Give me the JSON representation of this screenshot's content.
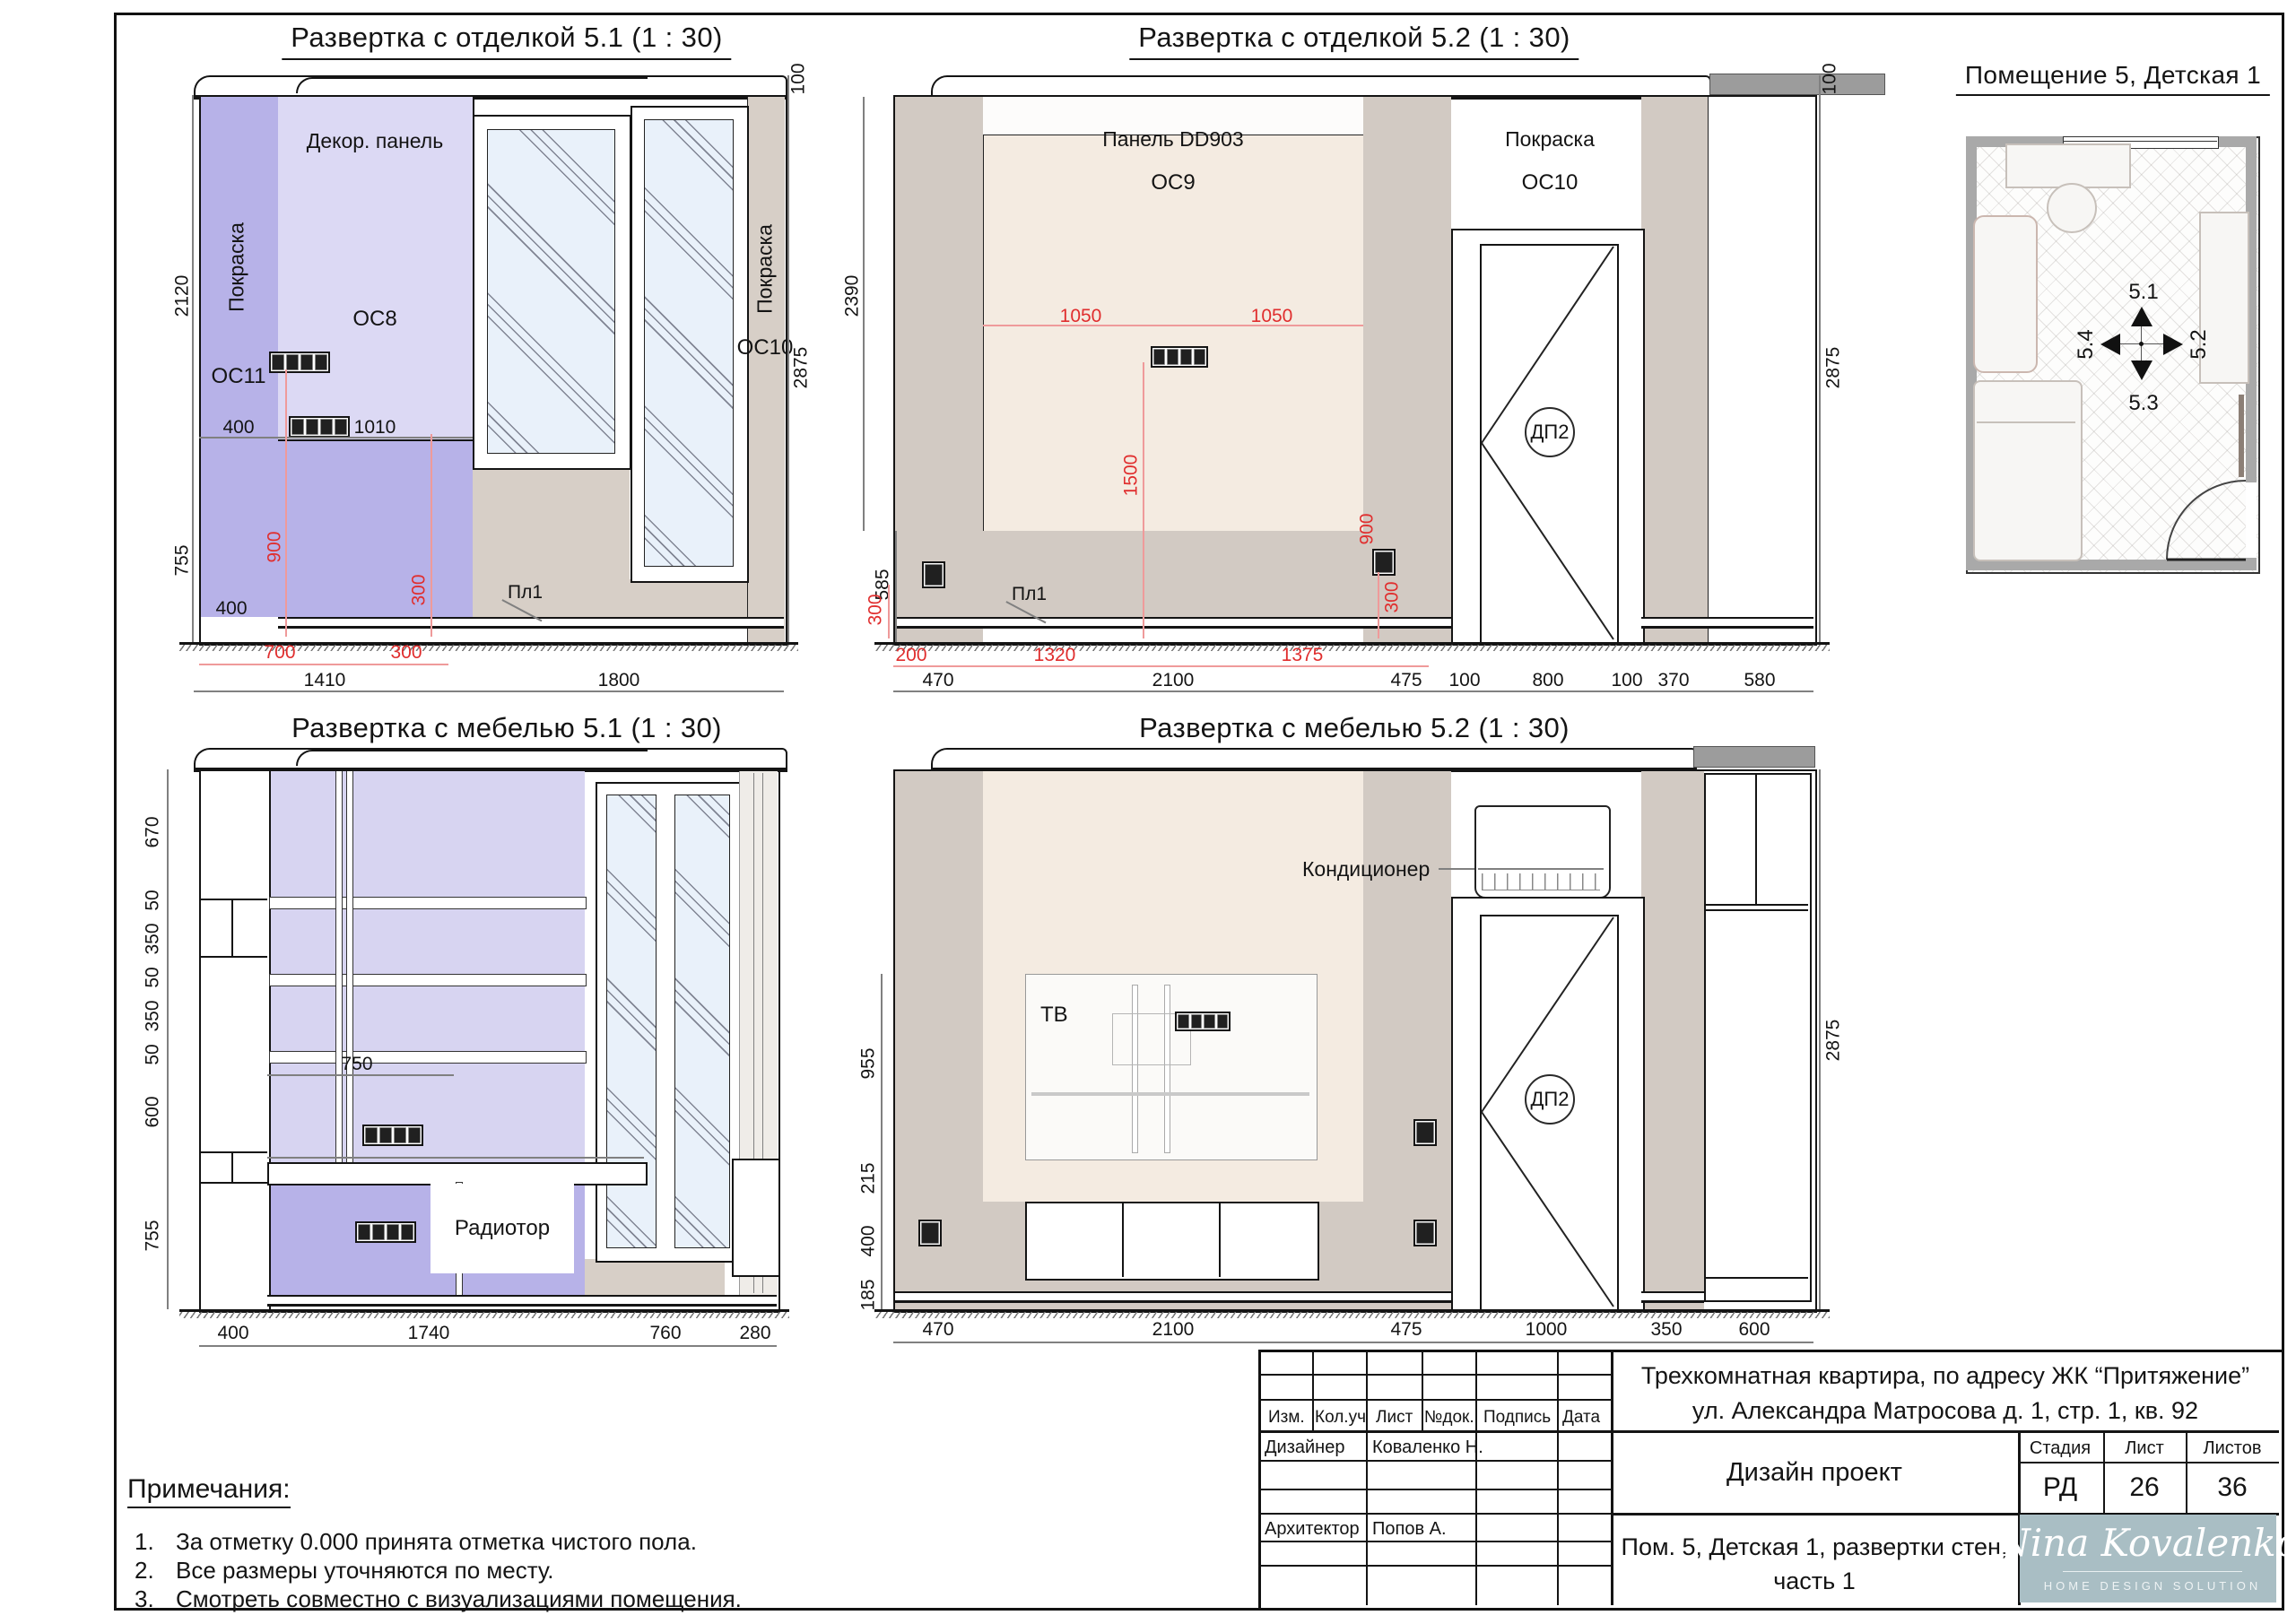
{
  "titles": {
    "d1": "Развертка с отделкой 5.1 (1 : 30)",
    "d2": "Развертка с отделкой 5.2 (1 : 30)",
    "d3": "Развертка с мебелью 5.1 (1 : 30)",
    "d4": "Развертка с мебелью 5.2 (1 : 30)",
    "plan": "Помещение 5, Детская 1"
  },
  "d1": {
    "paint_left": "Покраска",
    "os11": "ОС11",
    "decor_panel": "Декор. панель",
    "os8": "ОС8",
    "paint_right": "Покраска",
    "os10": "ОС10",
    "pl1": "Пл1",
    "dims": {
      "h2120": "2120",
      "h755": "755",
      "w400": "400",
      "w1010": "1010",
      "w400b": "400",
      "w1410": "1410",
      "w1800": "1800",
      "h100": "100",
      "h2875": "2875",
      "r700": "700",
      "r300": "300",
      "r900": "900",
      "r300v": "300"
    }
  },
  "d2": {
    "panel": "Панель DD903",
    "os9": "ОС9",
    "paint": "Покраска",
    "os10": "ОС10",
    "pl1": "Пл1",
    "door": "ДП2",
    "dims": {
      "h2390": "2390",
      "h585": "585",
      "h100": "100",
      "h2875": "2875",
      "r300l": "300",
      "r1050a": "1050",
      "r1050b": "1050",
      "r1500": "1500",
      "r900": "900",
      "r300r": "300",
      "r200": "200",
      "r1320": "1320",
      "r1375": "1375",
      "w470": "470",
      "w2100": "2100",
      "w475": "475",
      "w100a": "100",
      "w800": "800",
      "w100b": "100",
      "w370": "370",
      "w580": "580"
    }
  },
  "d3": {
    "radiator": "Радиотор",
    "dims": {
      "v670": "670",
      "v50a": "50",
      "v350a": "350",
      "v50b": "50",
      "v350b": "350",
      "v50c": "50",
      "v600": "600",
      "v755": "755",
      "w750": "750",
      "w400": "400",
      "w1740": "1740",
      "w760": "760",
      "w280": "280"
    }
  },
  "d4": {
    "ac": "Кондиционер",
    "tv": "ТВ",
    "door": "ДП2",
    "dims": {
      "v955": "955",
      "v215": "215",
      "v400": "400",
      "v185": "185",
      "w470": "470",
      "w2100": "2100",
      "w475": "475",
      "w1000": "1000",
      "w350": "350",
      "w600": "600",
      "h2875": "2875"
    }
  },
  "plan": {
    "m51": "5.1",
    "m52": "5.2",
    "m53": "5.3",
    "m54": "5.4"
  },
  "notes": {
    "title": "Примечания:",
    "items": [
      {
        "n": "1.",
        "t": "За отметку 0.000 принята отметка чистого пола."
      },
      {
        "n": "2.",
        "t": "Все размеры уточняются по месту."
      },
      {
        "n": "3.",
        "t": "Смотреть совместно с визуализациями помещения."
      }
    ]
  },
  "stamp": {
    "cols": [
      "Изм.",
      "Кол.уч",
      "Лист",
      "№док.",
      "Подпись",
      "Дата"
    ],
    "designer_role": "Дизайнер",
    "designer_name": "Коваленко Н.",
    "architect_role": "Архитектор",
    "architect_name": "Попов А.",
    "project_line1": "Трехкомнатная квартира, по адресу ЖК “Притяжение”",
    "project_line2": "ул. Александра Матросова д. 1, стр. 1, кв. 92",
    "doc_type": "Дизайн проект",
    "stage_h": "Стадия",
    "sheet_h": "Лист",
    "sheets_h": "Листов",
    "stage": "РД",
    "sheet": "26",
    "sheets": "36",
    "sheet_title1": "Пом. 5, Детская 1, развертки стен,",
    "sheet_title2": "часть 1",
    "logo_name": "Nina Kovalenko",
    "logo_sub": "HOME DESIGN SOLUTION"
  }
}
